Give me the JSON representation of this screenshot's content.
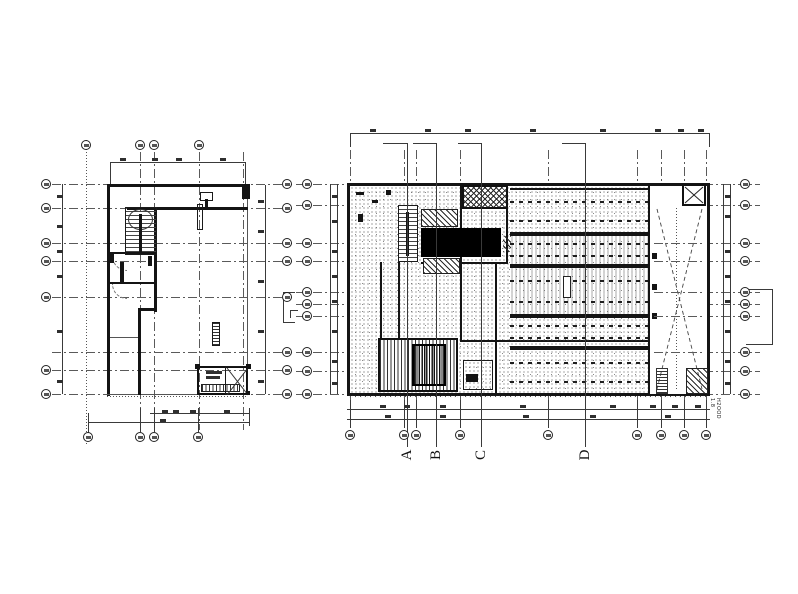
{
  "drawing": {
    "section_markers": [
      "A",
      "B",
      "C",
      "D"
    ],
    "right_margin_note": "H2OOD 1.8",
    "paper_color": "#ffffff",
    "line_color": "#1c1c1c",
    "black_fill_color": "#000000",
    "icons": {
      "grid_bubble": "circle-grid-bubble-icon",
      "elevator": "x-cross-shaft-icon",
      "stair": "stair-treads-icon",
      "brace": "diagonal-x-brace-icon"
    }
  }
}
